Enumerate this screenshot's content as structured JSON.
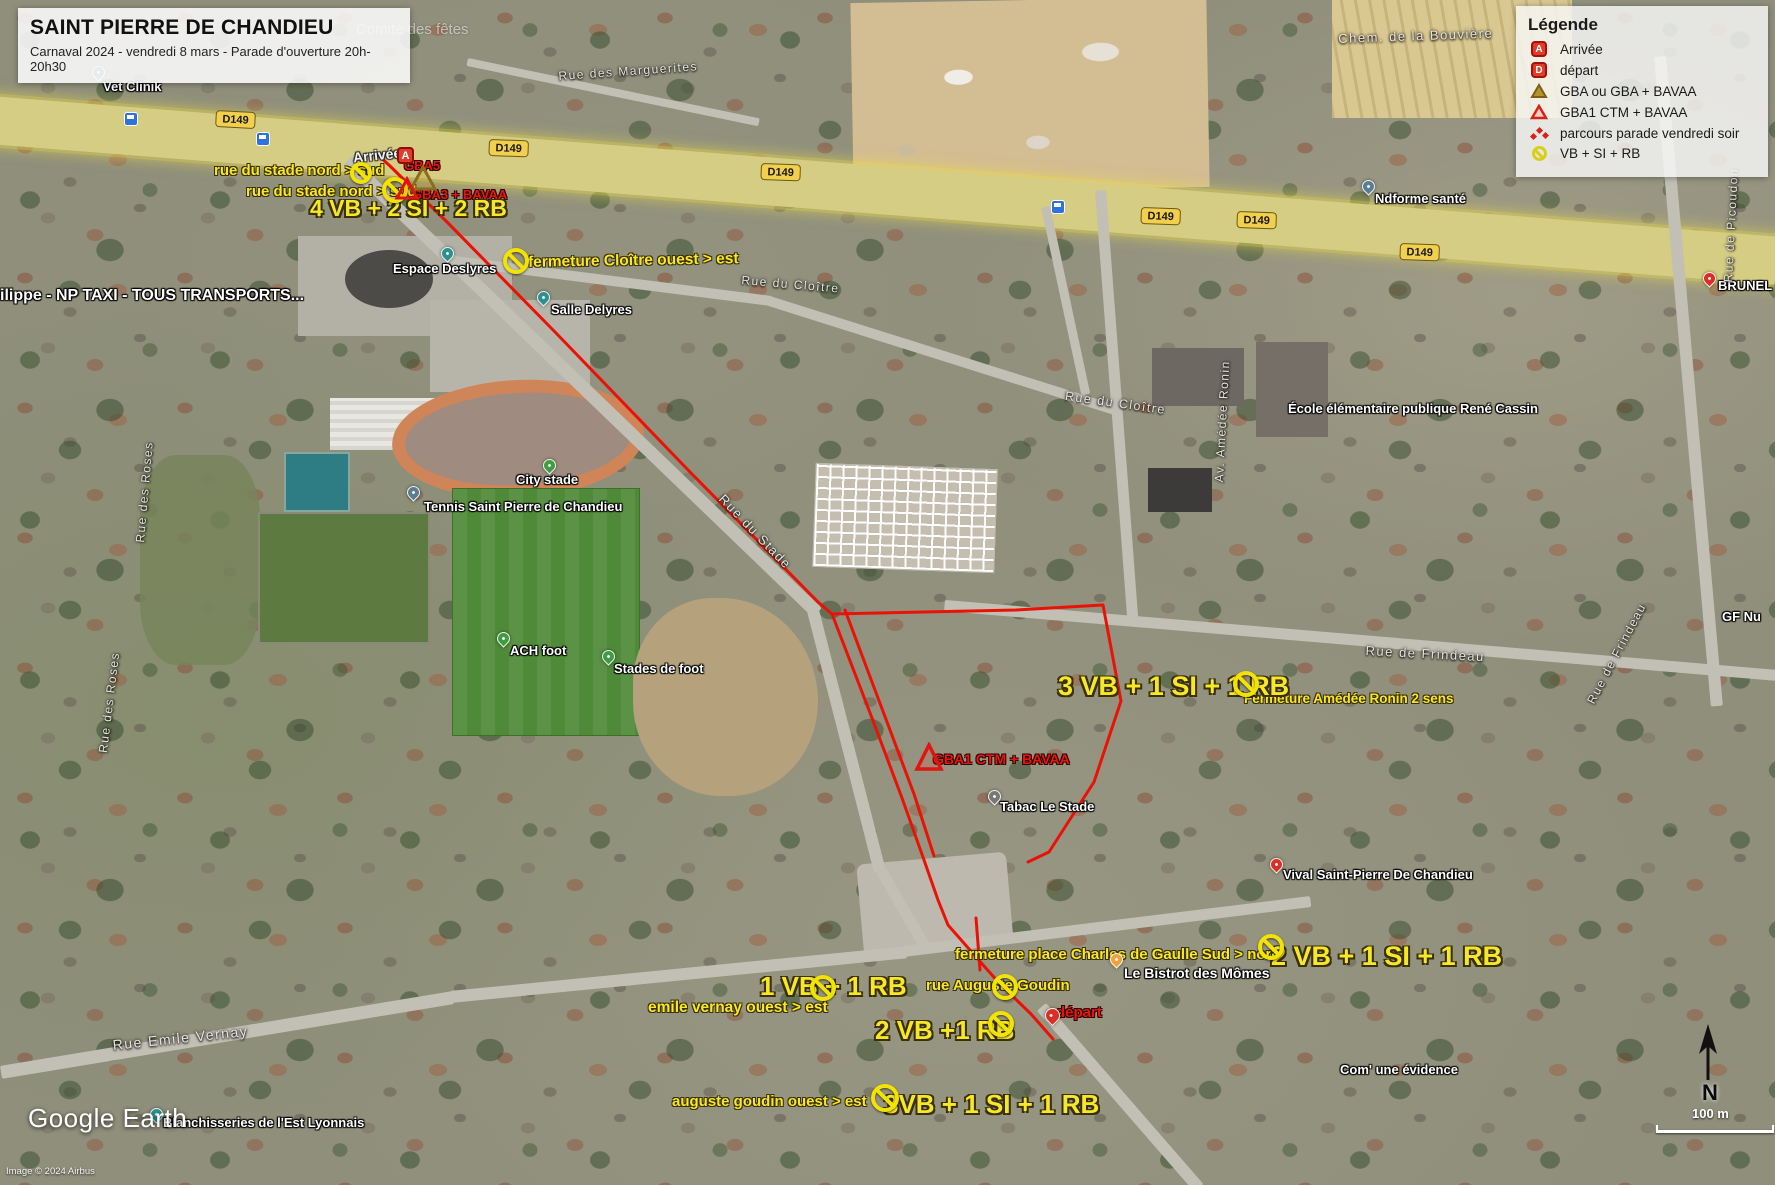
{
  "header": {
    "title": "SAINT PIERRE DE CHANDIEU",
    "subtitle": "Carnaval 2024 - vendredi 8 mars - Parade d'ouverture 20h-20h30",
    "watermark": "Comité des fêtes"
  },
  "legend": {
    "title": "Légende",
    "items": [
      {
        "letter": "A",
        "label": "Arrivée"
      },
      {
        "letter": "D",
        "label": "départ"
      },
      {
        "label": "GBA ou GBA + BAVAA"
      },
      {
        "label": "GBA1 CTM + BAVAA"
      },
      {
        "label": "parcours parade vendredi soir"
      },
      {
        "label": "VB + SI + RB"
      }
    ]
  },
  "markers": {
    "arrivee_label": "Arrivée",
    "arrivee_letter": "A",
    "gba5": "GBA5",
    "gba3": "GBA3 + BAVAA",
    "gba1": "GBA1 CTM + BAVAA",
    "depart": "départ"
  },
  "closures": [
    "rue du stade nord > sud",
    "rue du stade nord > sud",
    "fermeture Cloître ouest > est",
    "Fermeture Amédée Ronin 2 sens",
    "fermeture place Charles de Gaulle Sud > nord",
    "emile vernay ouest > est",
    "rue Auguste Goudin",
    "auguste goudin ouest > est"
  ],
  "counts": [
    "4 VB + 2 SI + 2 RB",
    "3 VB + 1 SI + 1 RB",
    "2 VB + 1 SI + 1 RB",
    "1 VB + 1 RB",
    "2 VB +1 RB",
    "3VB + 1 SI + 1 RB"
  ],
  "poi": [
    "Vet Clinik",
    "ilippe - NP TAXI - TOUS TRANSPORTS...",
    "Espace Deslyres",
    "Salle Delyres",
    "Tennis Saint Pierre de Chandieu",
    "City stade",
    "ACH foot",
    "Stades de foot",
    "Tabac Le Stade",
    "Vival Saint-Pierre De Chandieu",
    "Le Bistrot des Mômes",
    "École élémentaire publique René Cassin",
    "Ndforme santé",
    "BRUNEL C",
    "Com' une évidence",
    "Blanchisseries de l'Est Lyonnais",
    "GF Nu"
  ],
  "streets": [
    "Chem. de la Bouvière",
    "Rue des Marguerites",
    "Rue du Cloître",
    "Rue du Cloître",
    "Rue du Stade",
    "Rue des Roses",
    "Rue des Roses",
    "Rue Emile Vernay",
    "Av. Amédée Ronin",
    "Rue de Frindeau",
    "Rue de Frindeau",
    "Rue de Picoudon"
  ],
  "shield": "D149",
  "footer": {
    "logo": "Google Earth",
    "credit": "Image © 2024 Airbus",
    "scale_label": "100 m",
    "north_label": "N"
  },
  "colors": {
    "route": "#ea1206",
    "closure_text": "#f6e72a",
    "red_text": "#e8150c",
    "d149_highlight": "#eede46"
  }
}
